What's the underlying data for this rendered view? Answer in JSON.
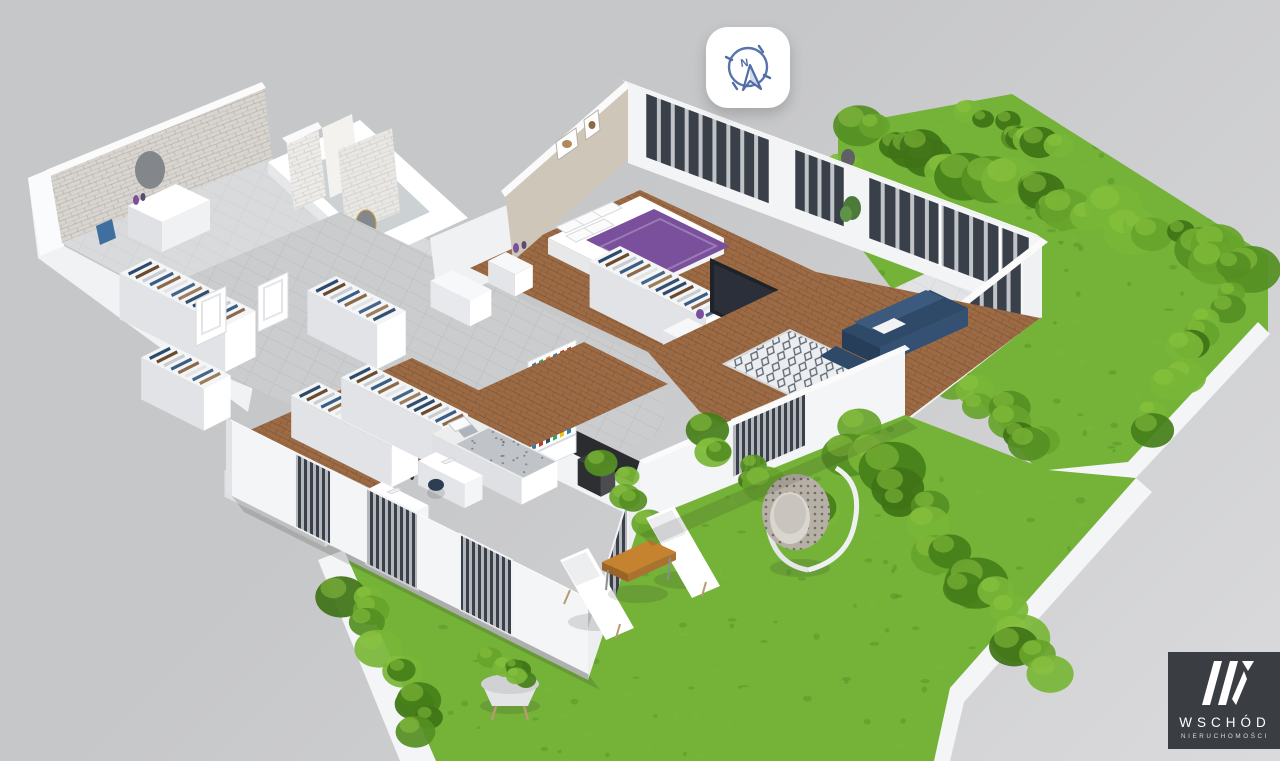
{
  "compass": {
    "icon": "compass-north-icon",
    "letter": "N"
  },
  "logo": {
    "mark": "W",
    "title": "WSCHÓD",
    "subtitle": "NIERUCHOMOŚCI"
  },
  "palette": {
    "bg1": "#c6c7c9",
    "bg2": "#dadadc",
    "wall": "#f7f8f9",
    "wallShade": "#e4e5e8",
    "wallDark": "#d3d4d7",
    "tileWall": "#d8d5d0",
    "floorTile": "#cbccce",
    "bathTile": "#d9dadb",
    "wood": "#9c6b45",
    "woodDark": "#7e5536",
    "grass": "#74b238",
    "grassDark": "#55972a",
    "hedge": "#4a8a1e",
    "hedgeLight": "#7ab73a",
    "accentPurple": "#7a4f9c",
    "accentNavy": "#2e4a68",
    "woodFurniture": "#c5822f",
    "counterDark": "#2b2c30",
    "windowGlass": "#3a4049",
    "curtain": "#d8dade",
    "compassBlue": "#4f6da6",
    "logoBg": "#3a3d42",
    "gold": "#c9a23e"
  }
}
